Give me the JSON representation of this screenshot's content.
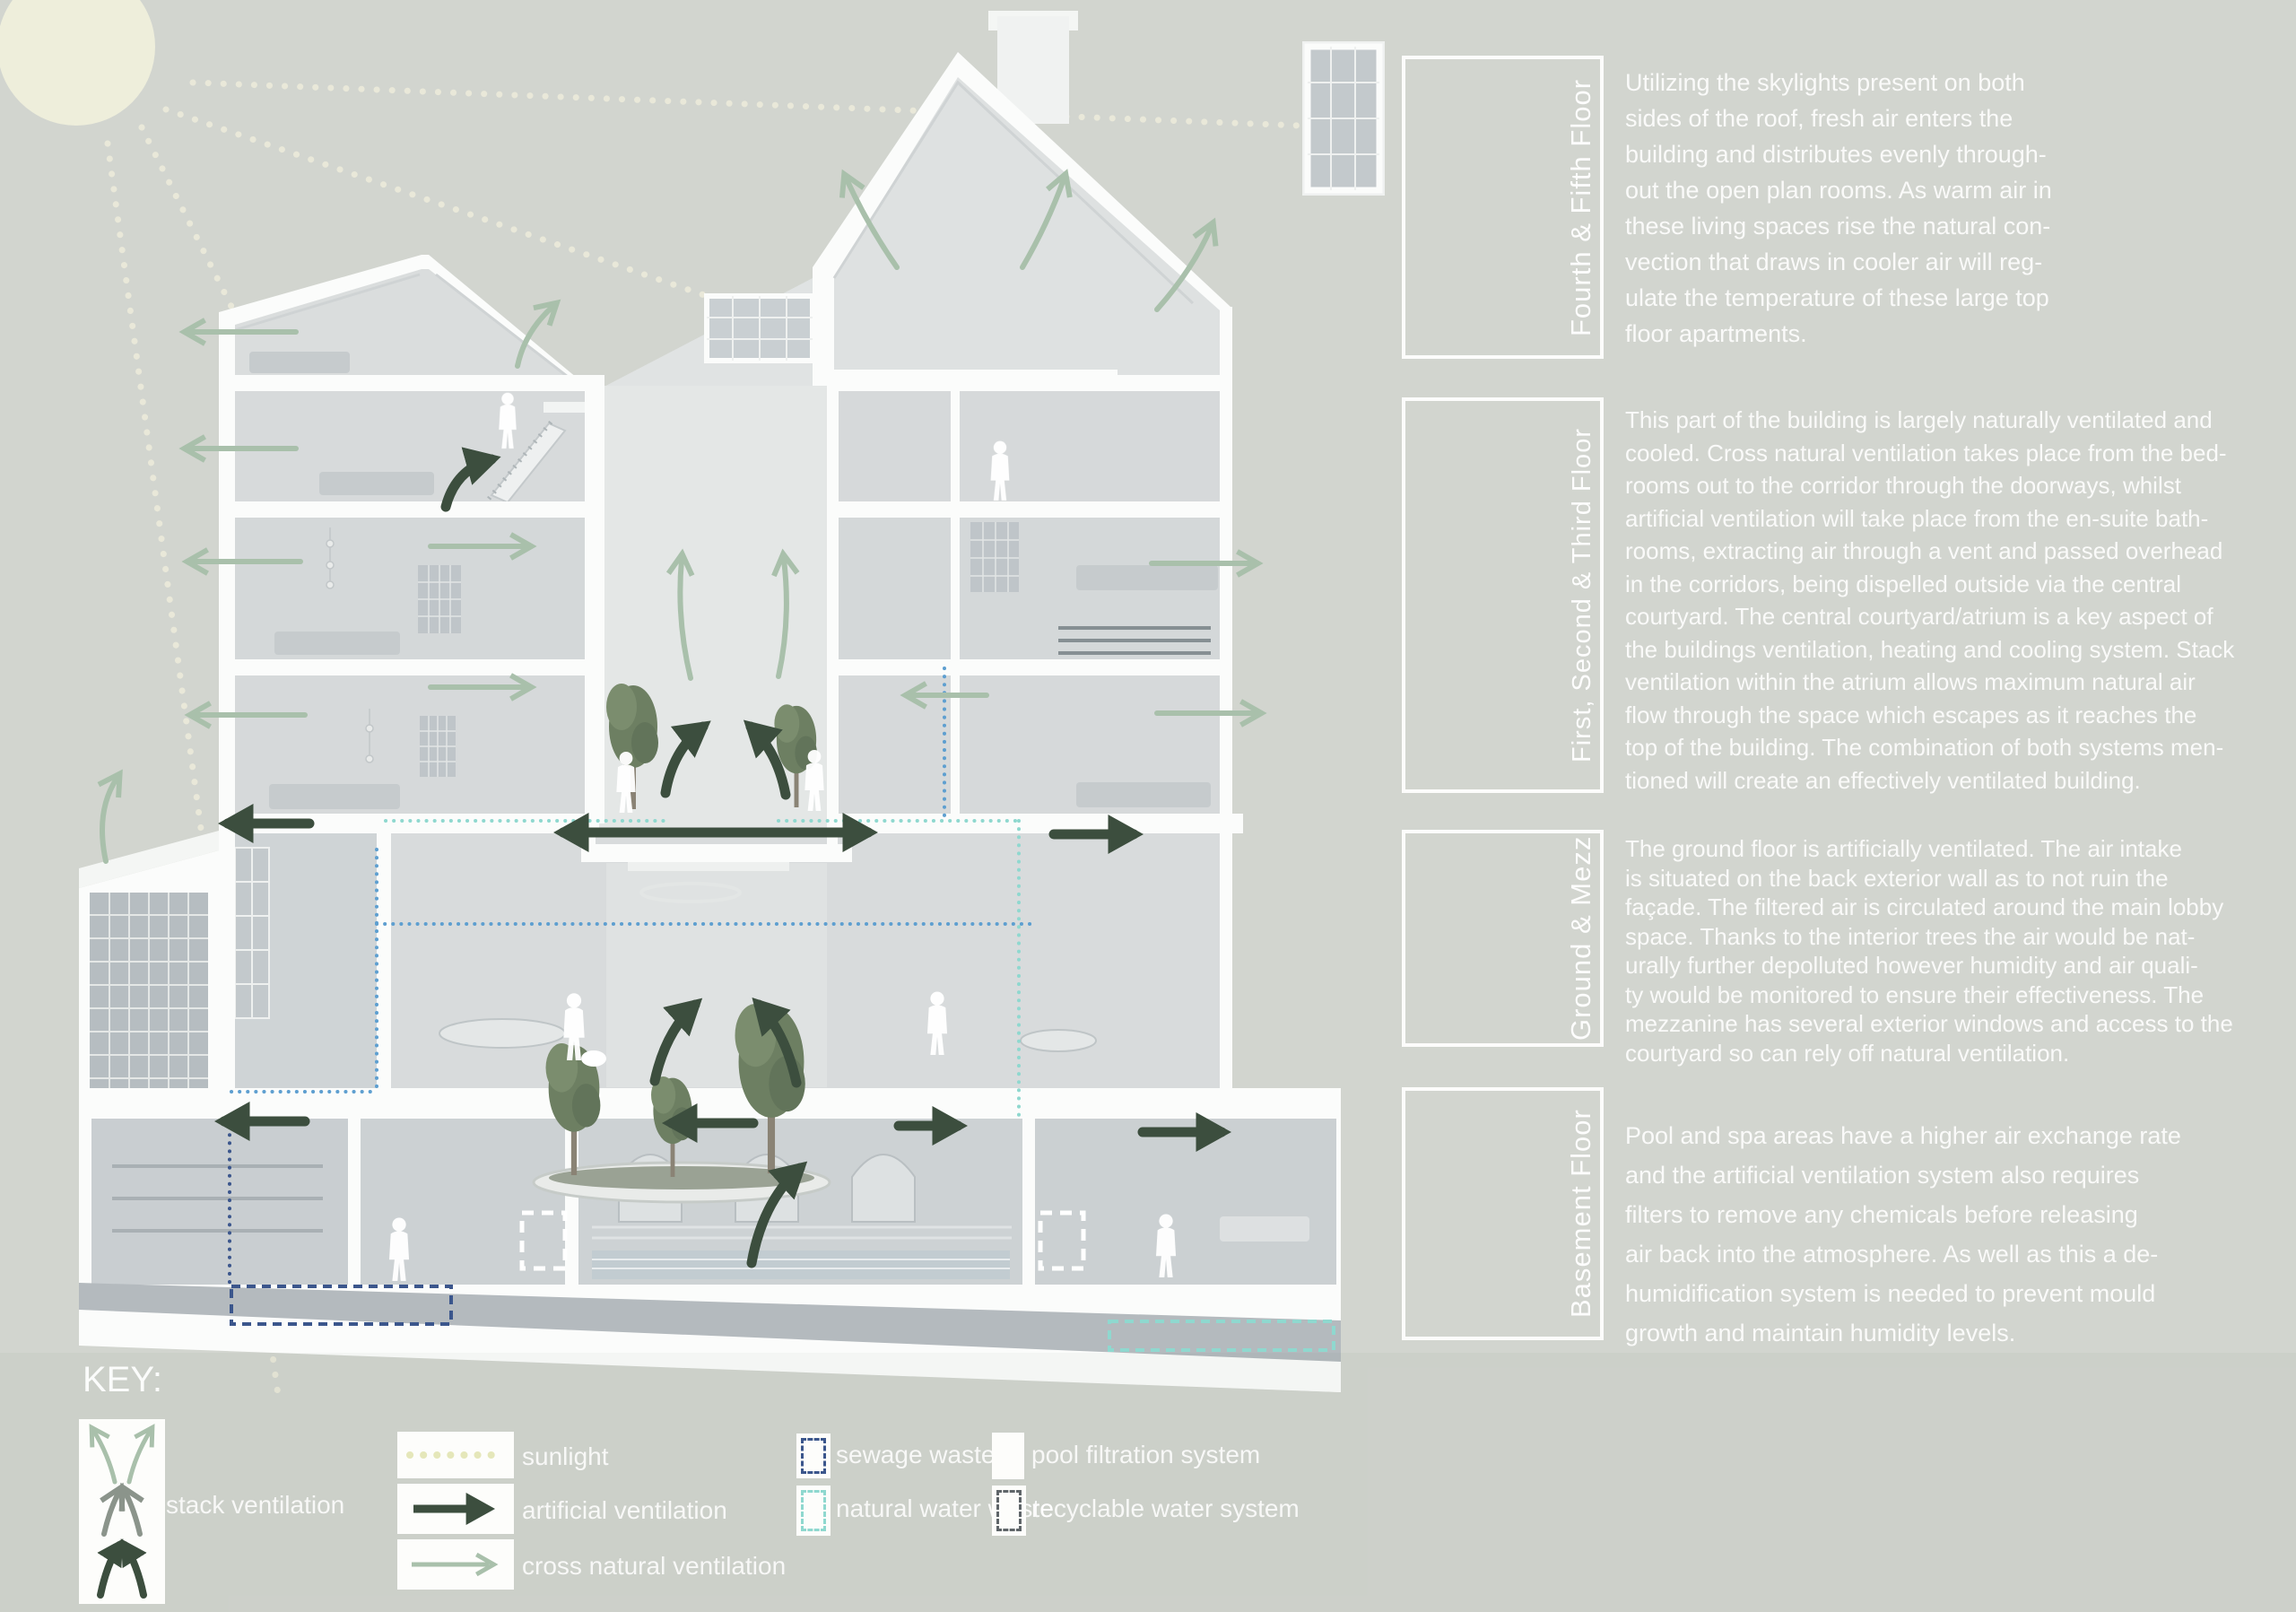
{
  "sections": {
    "fourth_fifth": {
      "label": "Fourth & Fifth Floor",
      "text": "Utilizing the skylights present on both\nsides of the roof, fresh air enters the\nbuilding and distributes evenly through-\nout the open plan rooms. As warm air in\nthese living spaces rise the natural con-\nvection that draws in cooler air will reg-\nulate the temperature of these large top\nfloor apartments."
    },
    "first_second_third": {
      "label": "First, Second & Third Floor",
      "text": "This part of the building is largely naturally ventilated and\ncooled. Cross natural ventilation takes place from the bed-\nrooms out to the corridor through the doorways, whilst\nartificial ventilation will take place from the en-suite bath-\nrooms, extracting air through a vent and passed overhead\nin the corridors, being dispelled outside via the central\ncourtyard. The central courtyard/atrium is a key aspect of\nthe buildings ventilation, heating and cooling system. Stack\nventilation within the atrium allows maximum natural air\nflow through the space which escapes as it reaches the\ntop of the building. The combination of both systems men-\ntioned will create an effectively ventilated building."
    },
    "ground_mezz": {
      "label": "Ground & Mezz",
      "text": "The ground floor is artificially ventilated. The air intake\nis situated on the back exterior wall as to not ruin the\nfaçade. The filtered air is circulated around the main lobby\nspace. Thanks to the interior trees the air would be nat-\nurally further depolluted however humidity and air quali-\nty would be monitored to ensure their effectiveness. The\nmezzanine has several exterior windows and access to the\ncourtyard so can rely off natural ventilation."
    },
    "basement": {
      "label": "Basement Floor",
      "text": "Pool and spa areas have a higher air exchange rate\nand the artificial ventilation system also requires\nfilters to remove any chemicals before releasing\nair back into the atmosphere. As well as this a de-\nhumidification system is needed to prevent mould\ngrowth and maintain humidity levels."
    }
  },
  "key": {
    "title": "KEY:",
    "items": [
      {
        "id": "stack-ventilation",
        "label": "stack ventilation"
      },
      {
        "id": "sunlight",
        "label": "sunlight",
        "color": "#e5e7ba"
      },
      {
        "id": "artificial-ventilation",
        "label": "artificial ventilation",
        "color": "#3c4e3e"
      },
      {
        "id": "cross-natural-ventilation",
        "label": "cross natural ventilation",
        "color": "#a9c0ab"
      },
      {
        "id": "sewage-waste",
        "label": "sewage waste",
        "color": "#3b568c"
      },
      {
        "id": "natural-water-waste",
        "label": "natural water waste",
        "color": "#8fd8cf"
      },
      {
        "id": "pool-filtration-system",
        "label": "pool filtration system",
        "color": "#ffffff"
      },
      {
        "id": "recyclable-water-system",
        "label": "recyclable water system",
        "color": "#5f6569"
      }
    ]
  },
  "colors": {
    "background": "#d2d5cf",
    "sun": "#eeeedb",
    "building_white": "#fbfcfb",
    "text_white": "#f4f5f1",
    "duct_blue": "#5e9fd0"
  }
}
